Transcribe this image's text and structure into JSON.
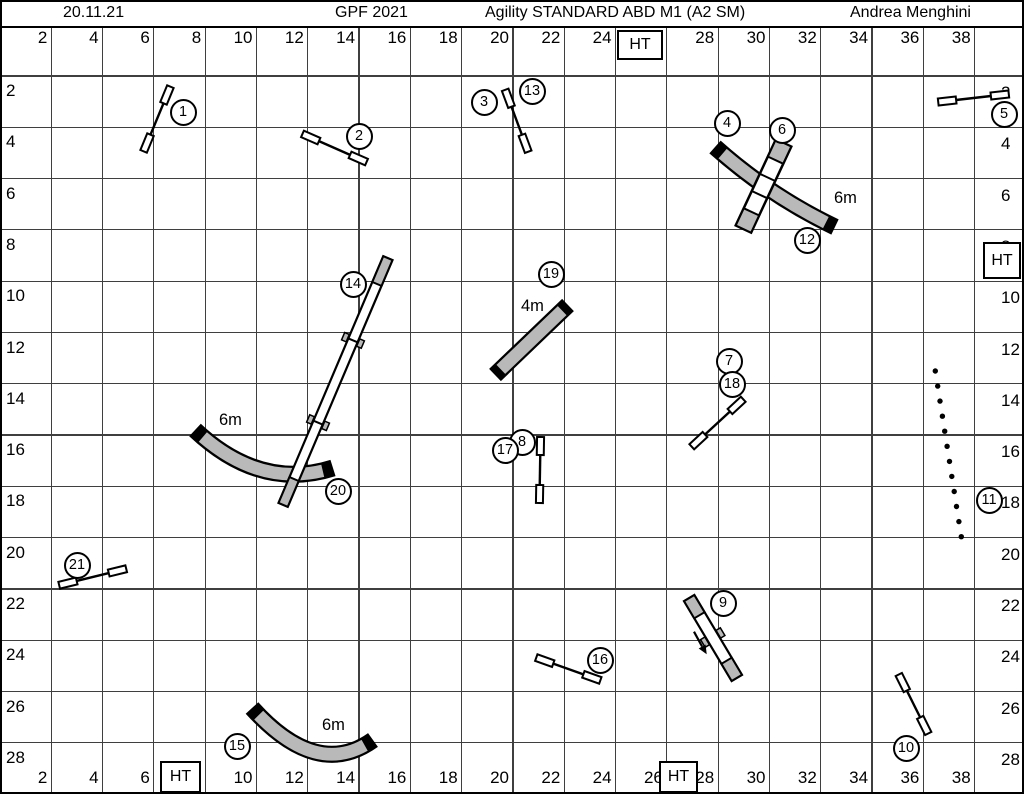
{
  "header": {
    "date": "20.11.21",
    "event": "GPF 2021",
    "title": "Agility STANDARD ABD M1 (A2 SM)",
    "judge": "Andrea Menghini"
  },
  "ht": {
    "label": "HT"
  },
  "axis": {
    "top": [
      "2",
      "4",
      "6",
      "8",
      "10",
      "12",
      "14",
      "16",
      "18",
      "20",
      "22",
      "24",
      "28",
      "30",
      "32",
      "34",
      "36",
      "38"
    ],
    "bottom": [
      "2",
      "4",
      "6",
      "10",
      "12",
      "14",
      "16",
      "18",
      "20",
      "22",
      "24",
      "26",
      "28",
      "30",
      "32",
      "34",
      "36",
      "38"
    ],
    "left": [
      "2",
      "4",
      "6",
      "8",
      "10",
      "12",
      "14",
      "16",
      "18",
      "20",
      "22",
      "24",
      "26",
      "28"
    ],
    "right": [
      "2",
      "4",
      "6",
      "8",
      "10",
      "12",
      "14",
      "16",
      "18",
      "20",
      "22",
      "24",
      "26",
      "28"
    ]
  },
  "tunnel_labels": [
    {
      "text": "6m"
    },
    {
      "text": "6m"
    },
    {
      "text": "4m"
    },
    {
      "text": "6m"
    }
  ],
  "obstacle_numbers": [
    {
      "n": "1",
      "x": 183,
      "y": 112
    },
    {
      "n": "2",
      "x": 359,
      "y": 136
    },
    {
      "n": "3",
      "x": 484,
      "y": 102
    },
    {
      "n": "13",
      "x": 532,
      "y": 91
    },
    {
      "n": "4",
      "x": 727,
      "y": 123
    },
    {
      "n": "6",
      "x": 782,
      "y": 130
    },
    {
      "n": "5",
      "x": 1004,
      "y": 114
    },
    {
      "n": "12",
      "x": 807,
      "y": 240
    },
    {
      "n": "14",
      "x": 353,
      "y": 284
    },
    {
      "n": "19",
      "x": 551,
      "y": 274
    },
    {
      "n": "7",
      "x": 729,
      "y": 361
    },
    {
      "n": "18",
      "x": 732,
      "y": 384
    },
    {
      "n": "8",
      "x": 522,
      "y": 442
    },
    {
      "n": "17",
      "x": 505,
      "y": 450
    },
    {
      "n": "20",
      "x": 338,
      "y": 491
    },
    {
      "n": "11",
      "x": 989,
      "y": 500
    },
    {
      "n": "21",
      "x": 77,
      "y": 565
    },
    {
      "n": "9",
      "x": 723,
      "y": 603
    },
    {
      "n": "16",
      "x": 600,
      "y": 660
    },
    {
      "n": "15",
      "x": 237,
      "y": 746
    },
    {
      "n": "10",
      "x": 906,
      "y": 748
    }
  ],
  "weave_pole_count": 12
}
